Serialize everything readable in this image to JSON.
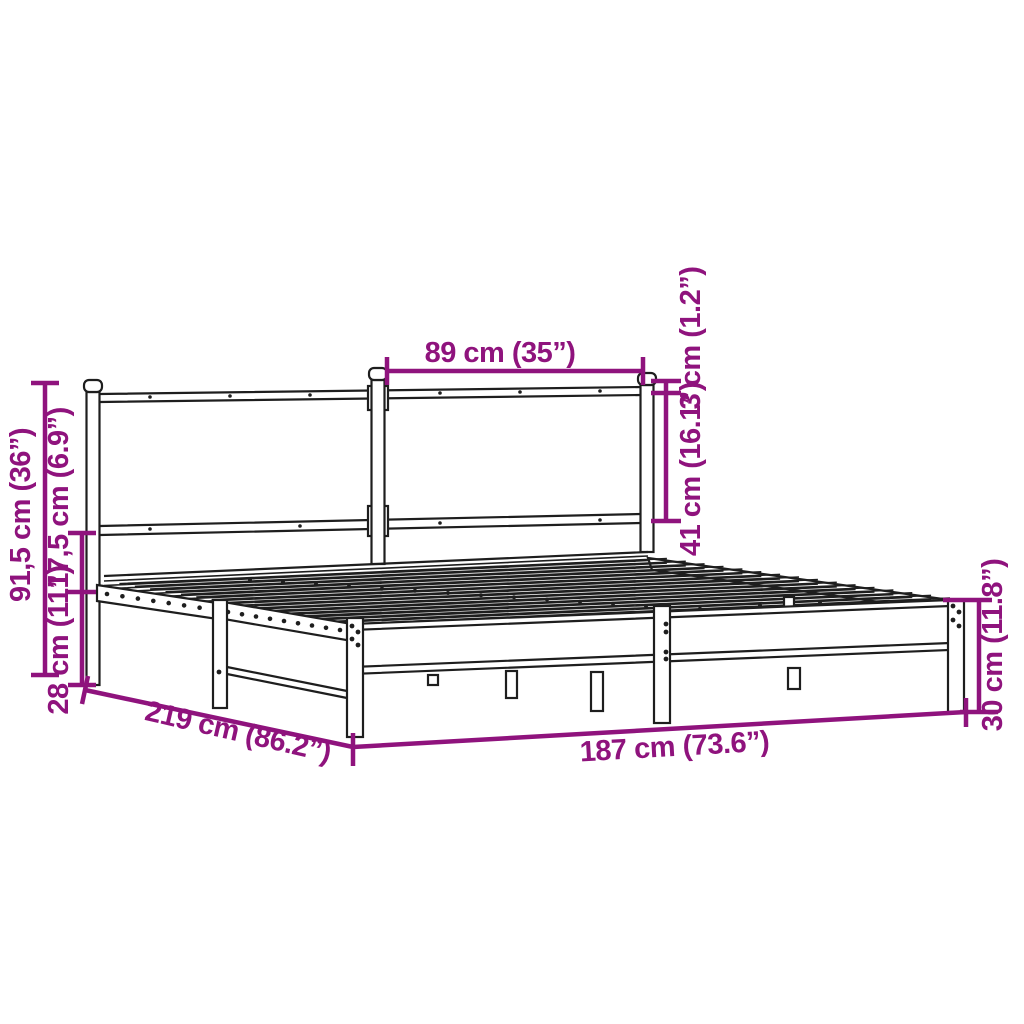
{
  "diagram": {
    "subject": "metal bed frame with headboard - dimension drawing",
    "colors": {
      "accent": "#8F137D",
      "line_art": "#1e1e1e",
      "background": "#ffffff"
    },
    "labels": {
      "headboard_section_width": "89 cm (35”)",
      "headboard_cap_offset": "3 cm (1.2”)",
      "headboard_panel_height": "41 cm (16.1”)",
      "total_height": "91,5 cm (36”)",
      "rail_gap_height": "17,5 cm (6.9”)",
      "underbed_clearance": "28 cm (11”)",
      "bed_length": "219 cm (86.2”)",
      "bed_width": "187 cm (73.6”)",
      "frame_height": "30 cm (11.8”)"
    }
  }
}
